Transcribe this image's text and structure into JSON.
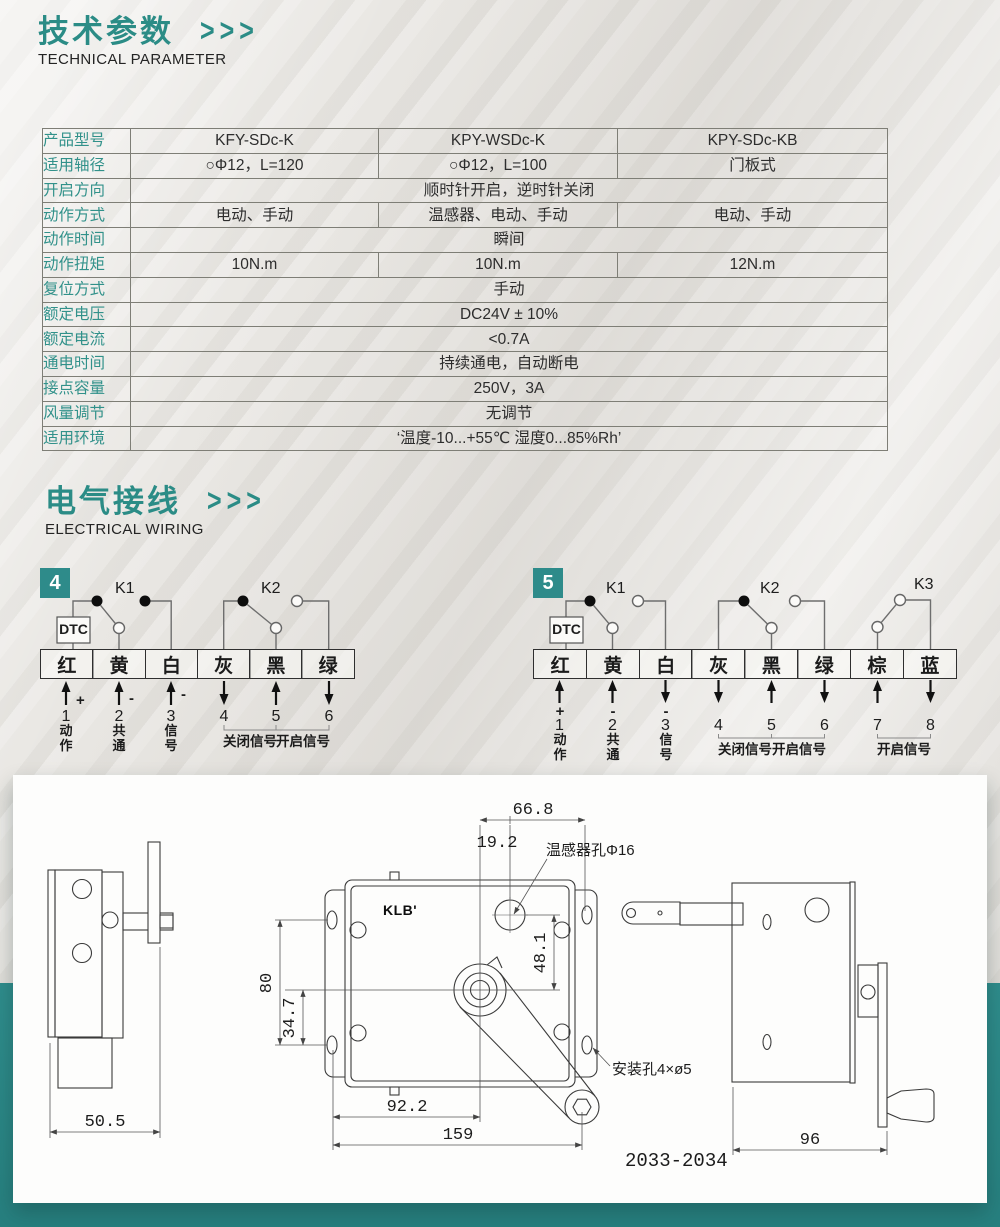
{
  "colors": {
    "accent": "#2b8c86",
    "band": "#2e8b8b"
  },
  "tech_header": {
    "title": "技术参数",
    "chevrons": ">>>",
    "subtitle": "TECHNICAL PARAMETER"
  },
  "wiring_header": {
    "title": "电气接线",
    "chevrons": ">>>",
    "subtitle": "ELECTRICAL WIRING"
  },
  "spec_table": {
    "rows": [
      {
        "label": "产品型号",
        "cells": [
          "KFY-SDc-K",
          "KPY-WSDc-K",
          "KPY-SDc-KB"
        ]
      },
      {
        "label": "适用轴径",
        "cells": [
          "○Φ12，L=120",
          "○Φ12，L=100",
          "门板式"
        ]
      },
      {
        "label": "开启方向",
        "span": "顺时针开启，逆时针关闭"
      },
      {
        "label": "动作方式",
        "cells": [
          "电动、手动",
          "温感器、电动、手动",
          "电动、手动"
        ]
      },
      {
        "label": "动作时间",
        "span": "瞬间"
      },
      {
        "label": "动作扭矩",
        "cells": [
          "10N.m",
          "10N.m",
          "12N.m"
        ]
      },
      {
        "label": "复位方式",
        "span": "手动"
      },
      {
        "label": "额定电压",
        "span": "DC24V ± 10%"
      },
      {
        "label": "额定电流",
        "span": "<0.7A"
      },
      {
        "label": "通电时间",
        "span": "持续通电，自动断电"
      },
      {
        "label": "接点容量",
        "span": "250V，3A"
      },
      {
        "label": "风量调节",
        "span": "无调节"
      },
      {
        "label": "适用环境",
        "span": "‘温度-10...+55℃ 湿度0...85%Rh’"
      }
    ]
  },
  "wiring": {
    "d4": {
      "badge": "4",
      "dtc": "DTC",
      "k1": "K1",
      "k2": "K2",
      "terminals": [
        "红",
        "黄",
        "白",
        "灰",
        "黑",
        "绿"
      ],
      "numbers": [
        "1",
        "2",
        "3",
        "4",
        "5",
        "6"
      ],
      "signs": [
        "+",
        "-",
        "-"
      ],
      "pin_labels": [
        "动作",
        "共通",
        "信号"
      ],
      "brackets": [
        "关闭信号",
        "开启信号"
      ]
    },
    "d5": {
      "badge": "5",
      "dtc": "DTC",
      "k1": "K1",
      "k2": "K2",
      "k3": "K3",
      "terminals": [
        "红",
        "黄",
        "白",
        "灰",
        "黑",
        "绿",
        "棕",
        "蓝"
      ],
      "numbers": [
        "1",
        "2",
        "3",
        "4",
        "5",
        "6",
        "7",
        "8"
      ],
      "signs": [
        "+",
        "-",
        "-"
      ],
      "pin_labels": [
        "动作",
        "共通",
        "信号"
      ],
      "brackets": [
        "关闭信号",
        "开启信号",
        "开启信号"
      ]
    }
  },
  "drawings": {
    "logo": "KLB'",
    "model": "2033-2034",
    "left_view": {
      "width": "50.5"
    },
    "front_view": {
      "dim_top": "66.8",
      "dim_offset": "19.2",
      "sensor_label": "温感器孔Φ16",
      "dim_sensor": "48.1",
      "dim_height": "80",
      "dim_lower": "34.7",
      "dim_hub": "92.2",
      "dim_total": "159",
      "mount_label": "安装孔4×ø5"
    },
    "side_view": {
      "width": "96"
    }
  }
}
